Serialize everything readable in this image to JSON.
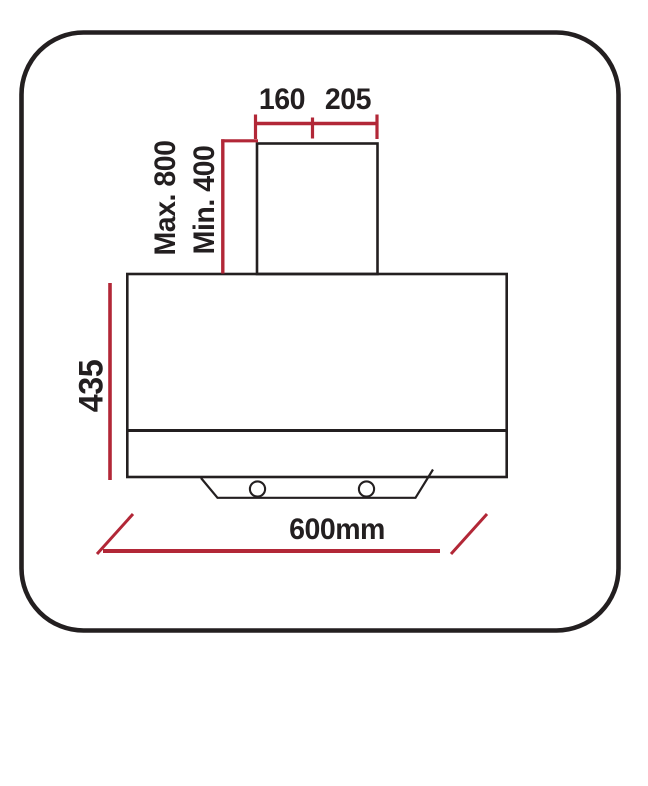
{
  "colors": {
    "red": "#b22737",
    "black": "#231f20",
    "background": "#ffffff"
  },
  "diagram": {
    "labels": {
      "duct_front_width": "160",
      "duct_side_width": "205",
      "chimney_max_height": "Max. 800",
      "chimney_min_height": "Min. 400",
      "body_height": "435",
      "overall_width": "600mm"
    }
  }
}
